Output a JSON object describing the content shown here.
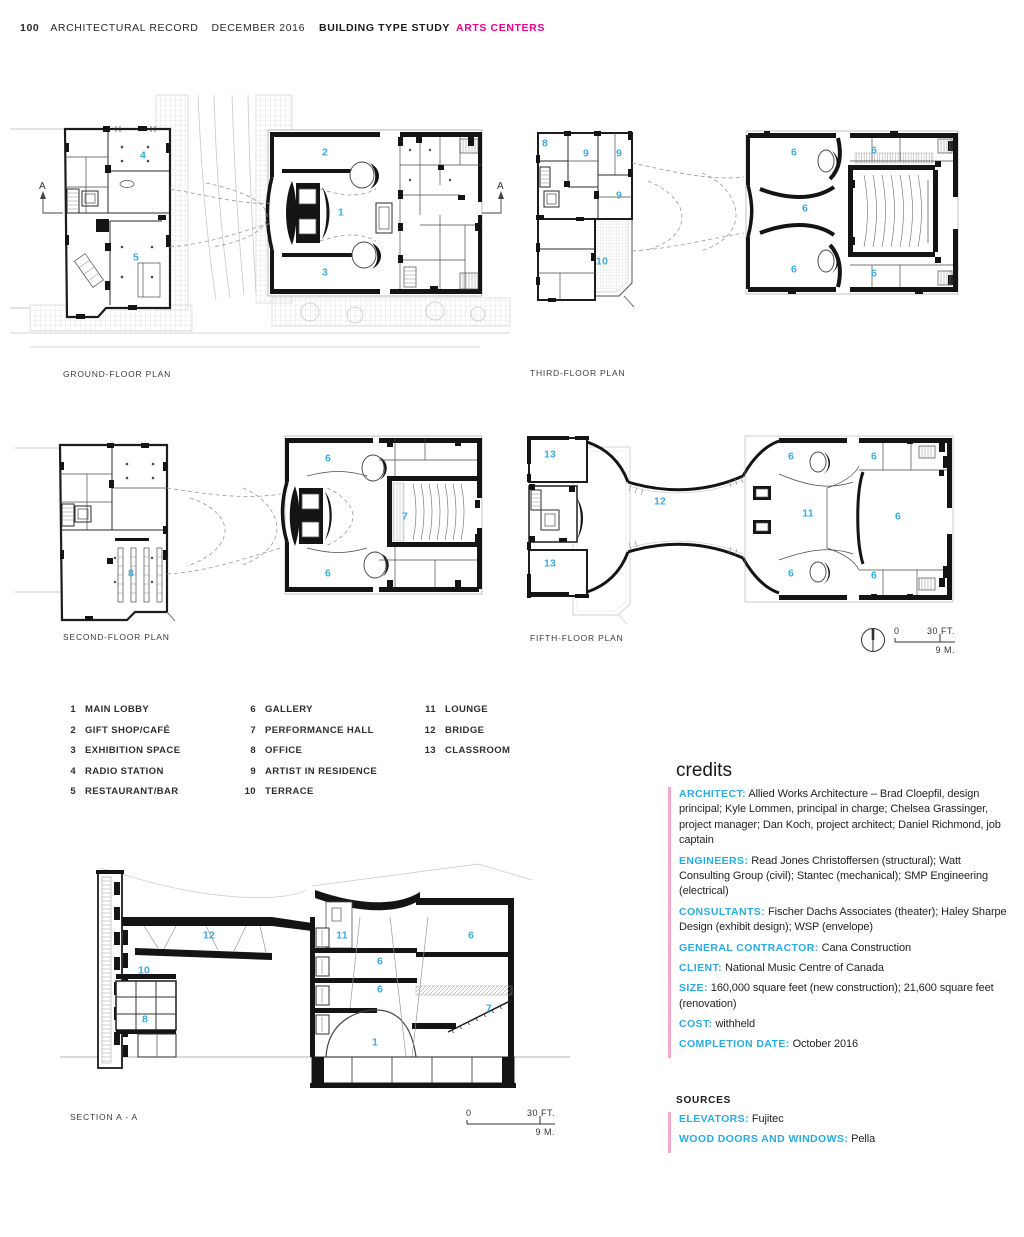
{
  "header": {
    "page_number": "100",
    "magazine": "ARCHITECTURAL RECORD",
    "issue": "DECEMBER 2016",
    "study": "BUILDING TYPE STUDY",
    "topic": "ARTS CENTERS"
  },
  "plans": [
    {
      "id": "ground-floor-plan",
      "caption": "GROUND-FLOOR PLAN",
      "section_markers": [
        "A",
        "A"
      ],
      "annotations": [
        {
          "n": "4",
          "x": 143,
          "y": 156
        },
        {
          "n": "2",
          "x": 325,
          "y": 153
        },
        {
          "n": "1",
          "x": 341,
          "y": 213
        },
        {
          "n": "3",
          "x": 325,
          "y": 273
        },
        {
          "n": "5",
          "x": 136,
          "y": 258
        }
      ]
    },
    {
      "id": "third-floor-plan",
      "caption": "THIRD-FLOOR PLAN",
      "annotations": [
        {
          "n": "8",
          "x": 545,
          "y": 144
        },
        {
          "n": "9",
          "x": 586,
          "y": 154
        },
        {
          "n": "9",
          "x": 619,
          "y": 154
        },
        {
          "n": "9",
          "x": 619,
          "y": 196
        },
        {
          "n": "10",
          "x": 602,
          "y": 262
        },
        {
          "n": "6",
          "x": 794,
          "y": 153
        },
        {
          "n": "6",
          "x": 874,
          "y": 151
        },
        {
          "n": "6",
          "x": 805,
          "y": 209
        },
        {
          "n": "6",
          "x": 794,
          "y": 270
        },
        {
          "n": "6",
          "x": 874,
          "y": 274
        }
      ]
    },
    {
      "id": "second-floor-plan",
      "caption": "SECOND-FLOOR PLAN",
      "annotations": [
        {
          "n": "8",
          "x": 131,
          "y": 574
        },
        {
          "n": "6",
          "x": 328,
          "y": 459
        },
        {
          "n": "6",
          "x": 328,
          "y": 574
        },
        {
          "n": "7",
          "x": 405,
          "y": 517
        }
      ]
    },
    {
      "id": "fifth-floor-plan",
      "caption": "FIFTH-FLOOR PLAN",
      "annotations": [
        {
          "n": "13",
          "x": 550,
          "y": 455
        },
        {
          "n": "13",
          "x": 550,
          "y": 564
        },
        {
          "n": "12",
          "x": 660,
          "y": 502
        },
        {
          "n": "6",
          "x": 791,
          "y": 457
        },
        {
          "n": "6",
          "x": 874,
          "y": 457
        },
        {
          "n": "11",
          "x": 808,
          "y": 514
        },
        {
          "n": "6",
          "x": 898,
          "y": 517
        },
        {
          "n": "6",
          "x": 791,
          "y": 574
        },
        {
          "n": "6",
          "x": 874,
          "y": 576
        }
      ]
    },
    {
      "id": "section-a-a",
      "caption": "SECTION A - A",
      "annotations": [
        {
          "n": "12",
          "x": 209,
          "y": 936
        },
        {
          "n": "10",
          "x": 144,
          "y": 971
        },
        {
          "n": "8",
          "x": 145,
          "y": 1020
        },
        {
          "n": "11",
          "x": 342,
          "y": 936
        },
        {
          "n": "6",
          "x": 380,
          "y": 962
        },
        {
          "n": "6",
          "x": 380,
          "y": 990
        },
        {
          "n": "6",
          "x": 471,
          "y": 936
        },
        {
          "n": "1",
          "x": 375,
          "y": 1043
        },
        {
          "n": "7",
          "x": 489,
          "y": 1009
        }
      ]
    }
  ],
  "legend": {
    "columns": [
      [
        {
          "num": "1",
          "label": "MAIN LOBBY"
        },
        {
          "num": "2",
          "label": "GIFT SHOP/CAFÉ"
        },
        {
          "num": "3",
          "label": "EXHIBITION SPACE"
        },
        {
          "num": "4",
          "label": "RADIO STATION"
        },
        {
          "num": "5",
          "label": "RESTAURANT/BAR"
        }
      ],
      [
        {
          "num": "6",
          "label": "GALLERY"
        },
        {
          "num": "7",
          "label": "PERFORMANCE HALL"
        },
        {
          "num": "8",
          "label": "OFFICE"
        },
        {
          "num": "9",
          "label": "ARTIST IN RESIDENCE"
        },
        {
          "num": "10",
          "label": "TERRACE"
        }
      ],
      [
        {
          "num": "11",
          "label": "LOUNGE"
        },
        {
          "num": "12",
          "label": "BRIDGE"
        },
        {
          "num": "13",
          "label": "CLASSROOM"
        }
      ]
    ]
  },
  "scale_bar": {
    "zero": "0",
    "feet": "30 FT.",
    "meters": "9 M."
  },
  "credits": {
    "heading": "credits",
    "entries": [
      {
        "label": "ARCHITECT:",
        "text": "Allied Works Architecture – Brad Cloepfil, design principal; Kyle Lommen, principal in charge; Chelsea Grassinger, project manager; Dan Koch, project architect; Daniel Richmond, job captain"
      },
      {
        "label": "ENGINEERS:",
        "text": "Read Jones Christoffersen (structural); Watt Consulting Group (civil); Stantec (mechanical); SMP Engineering (electrical)"
      },
      {
        "label": "CONSULTANTS:",
        "text": "Fischer Dachs Associates (theater); Haley Sharpe Design (exhibit design); WSP (envelope)"
      },
      {
        "label": "GENERAL CONTRACTOR:",
        "text": "Cana Construction"
      },
      {
        "label": "CLIENT:",
        "text": "National Music Centre of Canada"
      },
      {
        "label": "SIZE:",
        "text": "160,000 square feet (new construction); 21,600 square feet (renovation)"
      },
      {
        "label": "COST:",
        "text": "withheld"
      },
      {
        "label": "COMPLETION DATE:",
        "text": "October 2016"
      }
    ]
  },
  "sources": {
    "heading": "SOURCES",
    "entries": [
      {
        "label": "ELEVATORS:",
        "text": "Fujitec"
      },
      {
        "label": "WOOD DOORS AND WINDOWS:",
        "text": "Pella"
      }
    ]
  },
  "colors": {
    "accent_cyan": "#29ABE2",
    "accent_magenta": "#EC008C",
    "pink_rule": "#F4A7C9",
    "annotation_blue": "#3FA9E0",
    "ink": "#231F20"
  }
}
